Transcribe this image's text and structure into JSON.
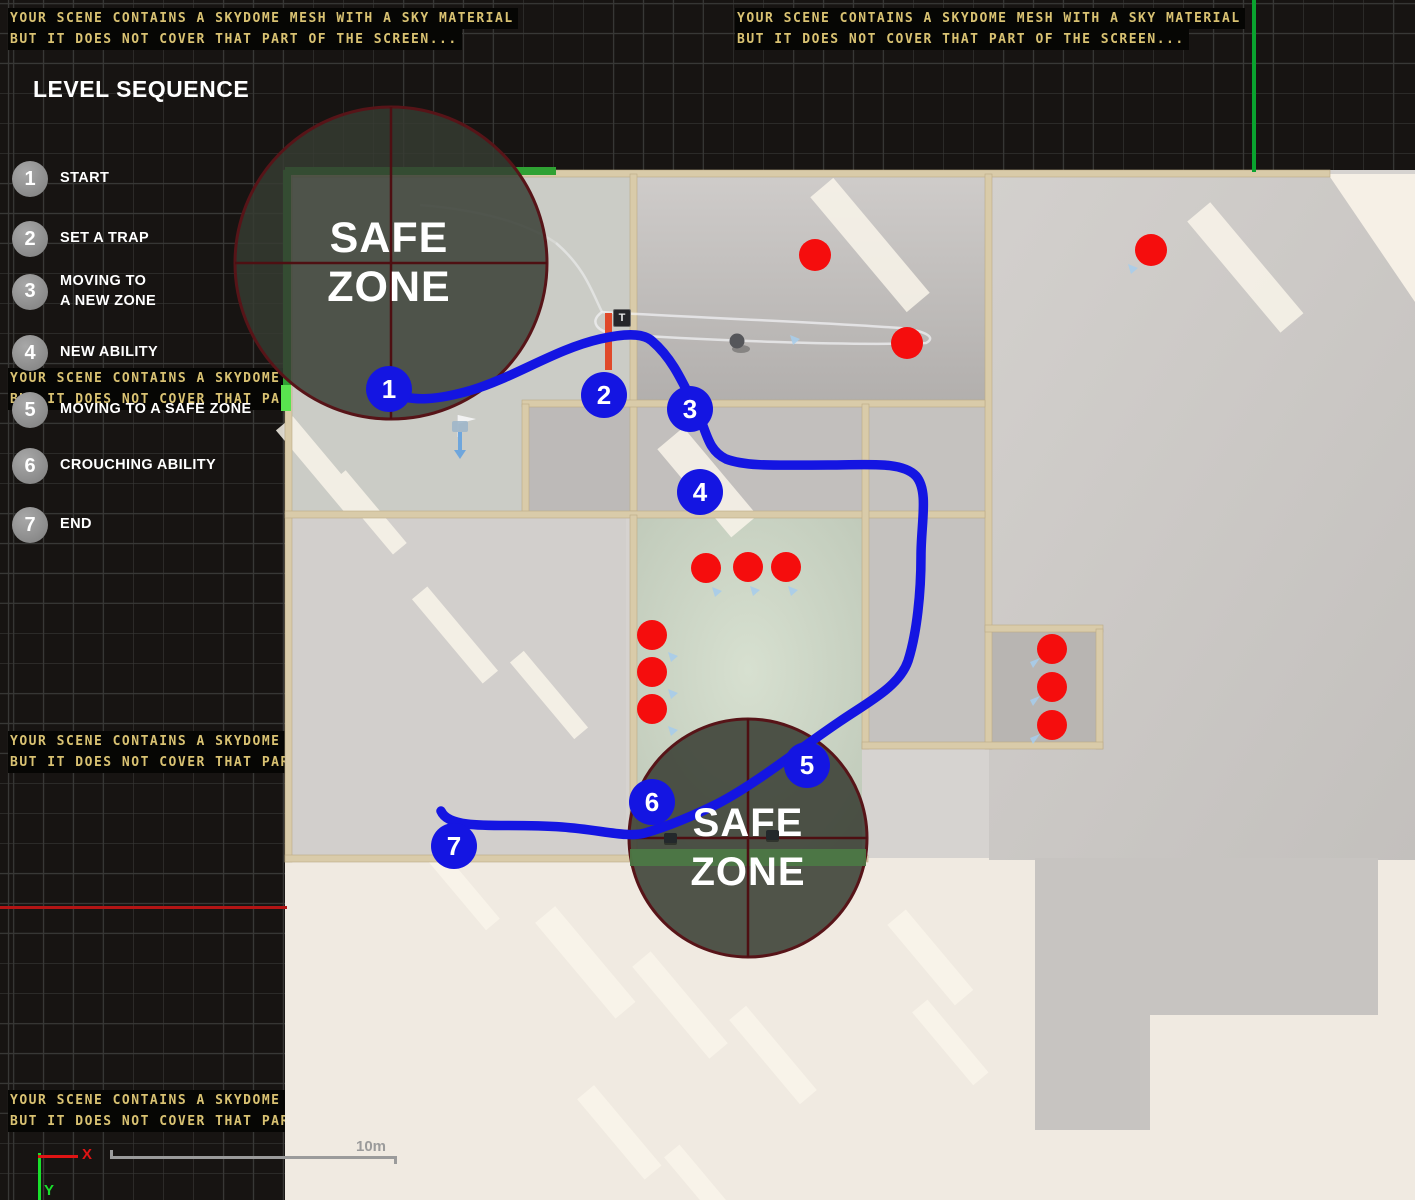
{
  "viewport": {
    "warning": {
      "line1": "YOUR SCENE CONTAINS A SKYDOME MESH WITH A SKY MATERIAL",
      "line2": "BUT IT DOES NOT COVER THAT PART OF THE SCREEN..."
    },
    "axis_gizmo": {
      "x_label": "X",
      "y_label": "Y"
    },
    "scale_bar": {
      "label": "10m"
    }
  },
  "legend": {
    "title": "LEVEL SEQUENCE",
    "items": [
      {
        "number": "1",
        "line1": "START",
        "line2": ""
      },
      {
        "number": "2",
        "line1": "SET A TRAP",
        "line2": ""
      },
      {
        "number": "3",
        "line1": "MOVING TO",
        "line2": "A NEW ZONE"
      },
      {
        "number": "4",
        "line1": "NEW ABILITY",
        "line2": ""
      },
      {
        "number": "5",
        "line1": "MOVING TO A SAFE ZONE",
        "line2": ""
      },
      {
        "number": "6",
        "line1": "CROUCHING ABILITY",
        "line2": ""
      },
      {
        "number": "7",
        "line1": "END",
        "line2": ""
      }
    ]
  },
  "map": {
    "trap_glyph": "T",
    "safe_zones": [
      {
        "line1": "SAFE",
        "line2": "ZONE"
      },
      {
        "line1": "SAFE",
        "line2": "ZONE"
      }
    ],
    "route_waypoints": [
      {
        "number": "1"
      },
      {
        "number": "2"
      },
      {
        "number": "3"
      },
      {
        "number": "4"
      },
      {
        "number": "5"
      },
      {
        "number": "6"
      },
      {
        "number": "7"
      }
    ],
    "enemy_count": "12"
  },
  "colors": {
    "route_blue": "#1415e2",
    "enemy_red": "#f50d0d",
    "warning_text": "#d9c272",
    "safe_zone_border": "#571418",
    "green_accent": "#2fa133"
  }
}
